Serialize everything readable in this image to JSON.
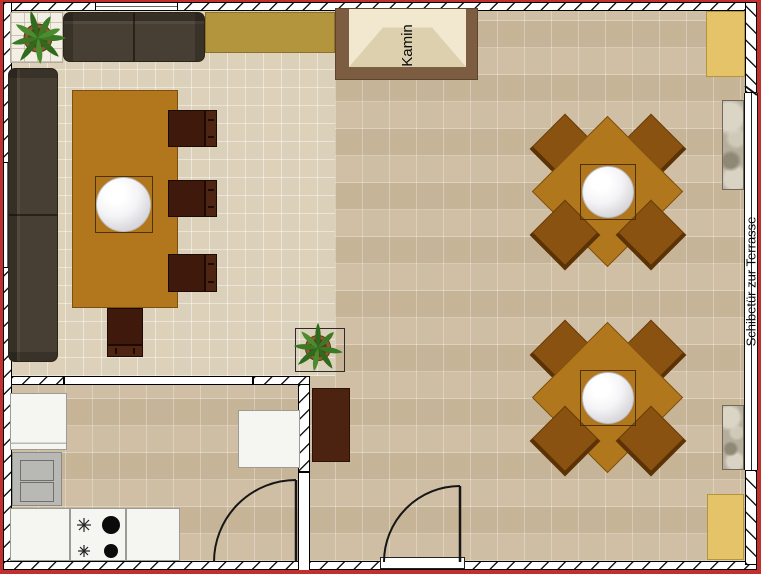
{
  "plan": {
    "labels": {
      "fireplace": "Kamin",
      "terrace_door": "Schibetür zur Terrasse"
    },
    "colors": {
      "outer_border_red": "#c22f2f",
      "floor_tile": "#d4c5aa",
      "living_floor_tile": "#e2d8c2",
      "table_wood": "#b2771c",
      "square_chair_wood": "#8a5210",
      "dining_chair_dark": "#3f1a0c",
      "sofa_brown": "#473f33",
      "sideboard_olive": "#b3953e",
      "cabinet_yellow": "#e4c369",
      "cabinet_dark_brown": "#4b2310",
      "fireplace_frame": "#7c5d42",
      "fireplace_inner": "#f1e8cf"
    }
  }
}
